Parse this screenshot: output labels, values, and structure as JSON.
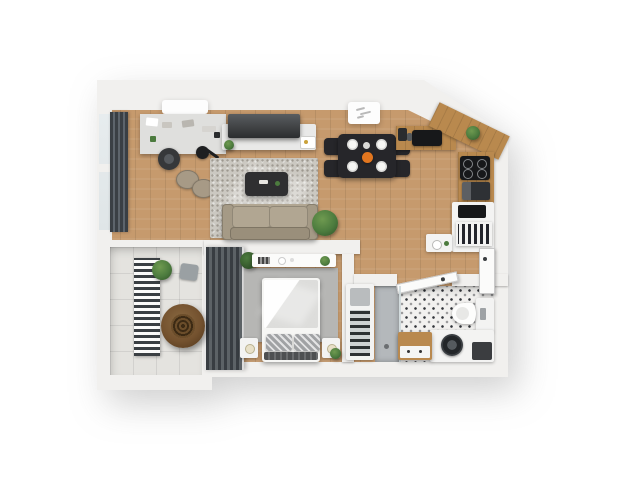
{
  "scene": {
    "description": "3D rendered top-down floor plan of a one-bedroom apartment on a white background"
  },
  "colors": {
    "background": "#ffffff",
    "wall": "#f1f0ee",
    "wood": "#c69a6d",
    "counter_wood": "#b9894e",
    "rug_living": "#cbc8c1",
    "rug_bedroom": "#b6b6b4",
    "sofa": "#b1a692",
    "coffee_table": "#2f2f31",
    "tv": "#2b2d2f",
    "console": "#e9e9e8",
    "dining_set": "#26262a",
    "plate": "#f6f6f4",
    "bowl": "#e2761f",
    "appliance": "#17181a",
    "cabinet": "#f3f3f2",
    "records": "#23252c",
    "plant": "#4c7b3e",
    "plant_dark": "#33552a",
    "curtain": "#3a3f44",
    "blind": "#383d42",
    "glass": "#e7ecee",
    "balcony_floor": "#e4e3df",
    "railing": "#3a3f43",
    "egg_chair": "#74522f",
    "tile_base": "#f2f1ef",
    "tile_ink": "#32353a",
    "shower": "#b4b8bb",
    "bed": "#f6f6f4",
    "pillow": "#a0a2a4",
    "runner": "#4e5052",
    "door": "#fbfbfa"
  },
  "rooms": {
    "living_room": {
      "label": "Living room",
      "furniture": [
        "ceiling-light-panel",
        "sideboard",
        "lounge-chair",
        "floor-lamp",
        "pouf",
        "pouf",
        "area-rug",
        "coffee-table",
        "sofa",
        "tv-console",
        "tv",
        "potted-plant",
        "window-with-curtains"
      ]
    },
    "dining_area": {
      "label": "Dining area",
      "furniture": [
        "ceiling-lamp",
        "dining-table",
        "dining-chair",
        "dining-chair",
        "dining-chair",
        "dining-chair",
        "plate",
        "plate",
        "plate",
        "plate",
        "serving-bowl",
        "side-dish"
      ]
    },
    "kitchen": {
      "label": "Kitchen",
      "furniture": [
        "countertop",
        "sink",
        "faucet",
        "cooktop",
        "coffee-machine",
        "tall-cabinet",
        "record-shelf",
        "counter-plant",
        "mug"
      ]
    },
    "hallway": {
      "label": "Hallway",
      "furniture": [
        "shoe-cabinet",
        "entrance-door",
        "bathroom-door"
      ]
    },
    "bedroom": {
      "label": "Bedroom",
      "furniture": [
        "double-bed",
        "pillow",
        "pillow",
        "bed-runner",
        "nightstand",
        "nightstand",
        "table-lamp",
        "table-lamp",
        "bedroom-rug",
        "wall-shelf",
        "potted-plant",
        "potted-plant",
        "slatted-window-wall"
      ]
    },
    "bathroom": {
      "label": "Bathroom",
      "furniture": [
        "walk-in-shower",
        "glass-screen",
        "floor-drain",
        "wall-hung-toilet",
        "flush-plate",
        "washing-machine",
        "vanity-counter",
        "wooden-cabinet",
        "patterned-tile-floor"
      ]
    },
    "balcony": {
      "label": "Balcony",
      "furniture": [
        "hanging-egg-chair",
        "slat-railing",
        "potted-plant",
        "side-table"
      ]
    }
  }
}
